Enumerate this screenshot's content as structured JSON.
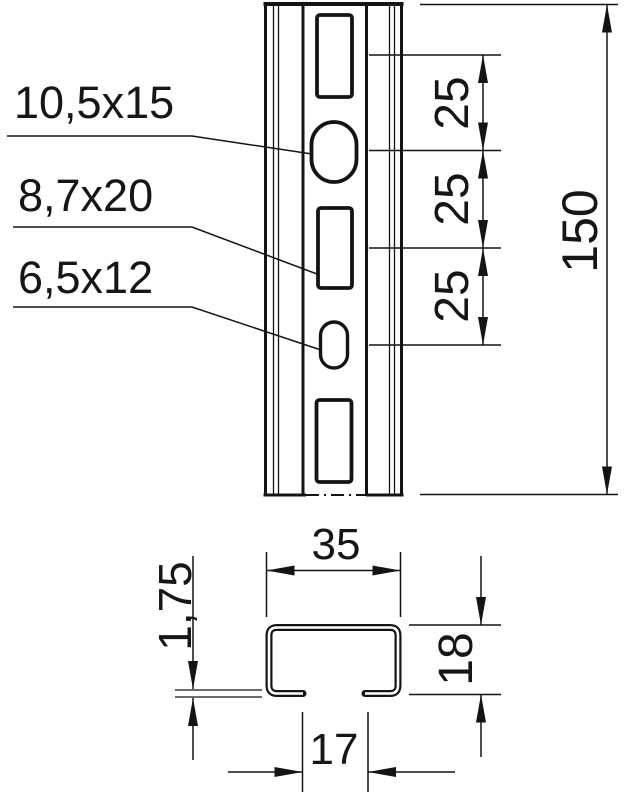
{
  "front_view": {
    "labels": [
      "10,5x15",
      "8,7x20",
      "6,5x12"
    ],
    "spacing_dims": [
      "25",
      "25",
      "25"
    ],
    "length_dim": "150"
  },
  "section_view": {
    "width_dim": "35",
    "thickness_dim": "1,75",
    "height_dim": "18",
    "opening_dim": "17"
  }
}
